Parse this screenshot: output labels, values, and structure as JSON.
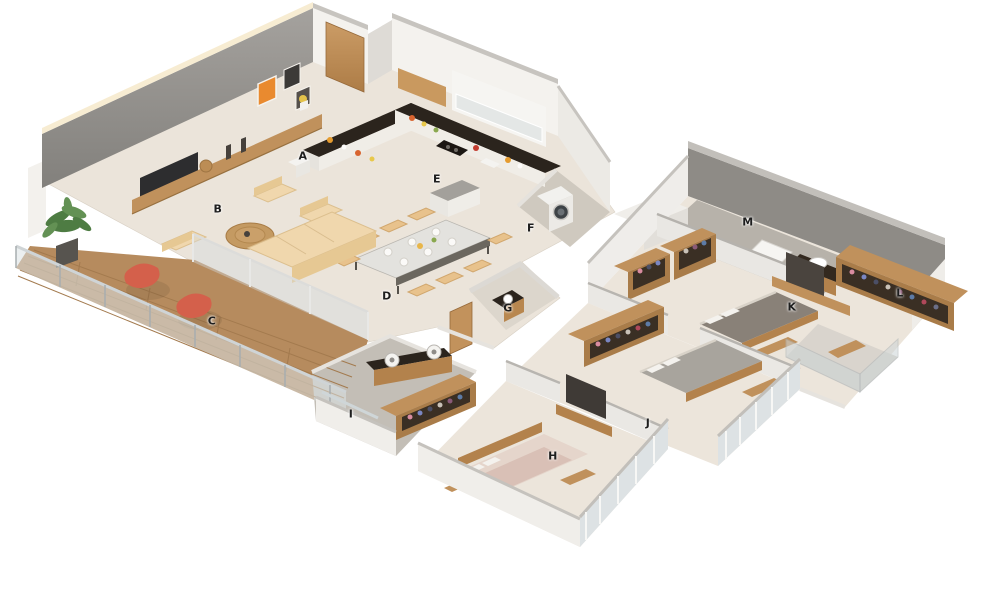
{
  "floorplan": {
    "type": "isometric-3d-apartment-floorplan",
    "labels": [
      {
        "text": "A",
        "x": 303,
        "y": 156
      },
      {
        "text": "B",
        "x": 218,
        "y": 209
      },
      {
        "text": "C",
        "x": 212,
        "y": 321
      },
      {
        "text": "D",
        "x": 387,
        "y": 296
      },
      {
        "text": "E",
        "x": 437,
        "y": 179
      },
      {
        "text": "F",
        "x": 531,
        "y": 228
      },
      {
        "text": "G",
        "x": 508,
        "y": 308
      },
      {
        "text": "H",
        "x": 553,
        "y": 456
      },
      {
        "text": "I",
        "x": 351,
        "y": 414
      },
      {
        "text": "J",
        "x": 648,
        "y": 423
      },
      {
        "text": "K",
        "x": 792,
        "y": 307
      },
      {
        "text": "L",
        "x": 900,
        "y": 293
      },
      {
        "text": "M",
        "x": 748,
        "y": 222
      }
    ],
    "palette": {
      "background": "#ffffff",
      "floor": "#ebe4da",
      "tile_gray": "#c3beb6",
      "wall_face": "#f2f0ec",
      "wall_top": "#c6c3be",
      "accent_gray_wall": "#8f8d8a",
      "dark_wall": "#8e8b86",
      "wood": "#c0915c",
      "wood_dark": "#a97c49",
      "deck_wood": "#b68b5e",
      "counter_dark": "#2b241d",
      "sofa_cream": "#f0d7ad",
      "chair_beige": "#e8c28c",
      "coral_chair": "#d4604b",
      "plant_green": "#4e7c43",
      "glass": "#d3dcdf",
      "bed_gray": "#898178",
      "label_color": "#1e1e1e"
    }
  }
}
